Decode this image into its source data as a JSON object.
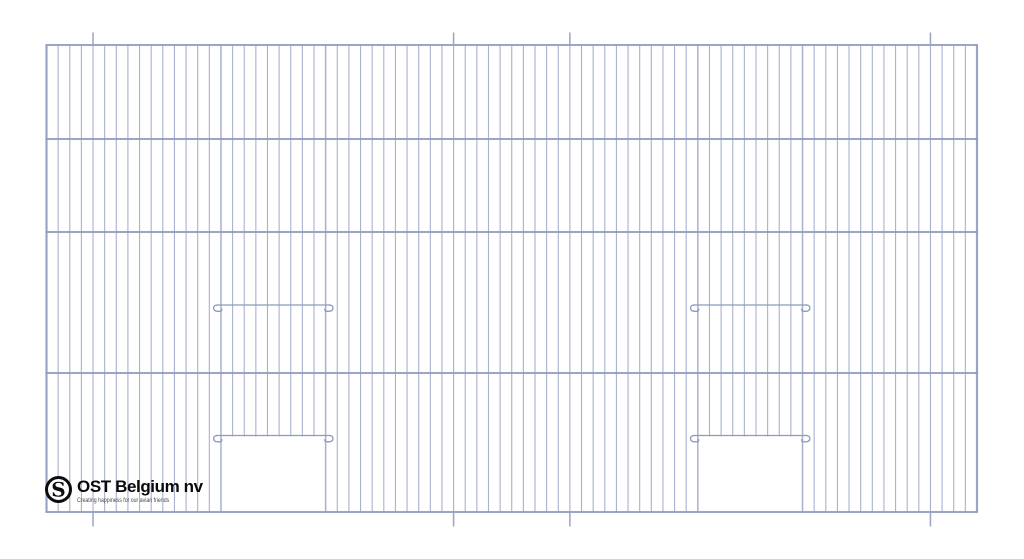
{
  "page": {
    "background": "#ffffff"
  },
  "panel": {
    "left": 46.5,
    "top": 45,
    "right": 977,
    "bottom": 512,
    "horizontal_wires_y": [
      45,
      139,
      232,
      373,
      512
    ],
    "vertical_wire_count": 81,
    "vertical_wire_spacing": 11.631,
    "hanger_wire_indices": [
      4,
      35,
      45,
      76
    ],
    "hanger_top_overhang": 12.5,
    "hanger_bottom_overhang": 14.5,
    "doors": [
      {
        "name": "left-door",
        "start_wire": 15,
        "end_wire": 24
      },
      {
        "name": "right-door",
        "start_wire": 56,
        "end_wire": 65
      }
    ],
    "door_bar_upper_y": 305,
    "door_bar_lower_y": 435.5,
    "colors": {
      "vertical_wire": "#a8b2cd",
      "horizontal_wire": "#8c9abc",
      "edge_wire": "#9aa5c4",
      "hanger_wire": "#98a4c2",
      "door_bar": "#8c9abc"
    },
    "stroke": {
      "vertical": 1.1,
      "horizontal": 1.8,
      "edge": 2.2,
      "door_edge": 1.5,
      "bar": 1.3,
      "hanger": 1.5
    }
  },
  "logo": {
    "monogram": "S",
    "company": "OST Belgium nv",
    "tagline": "Creating happiness for our avian friends"
  }
}
